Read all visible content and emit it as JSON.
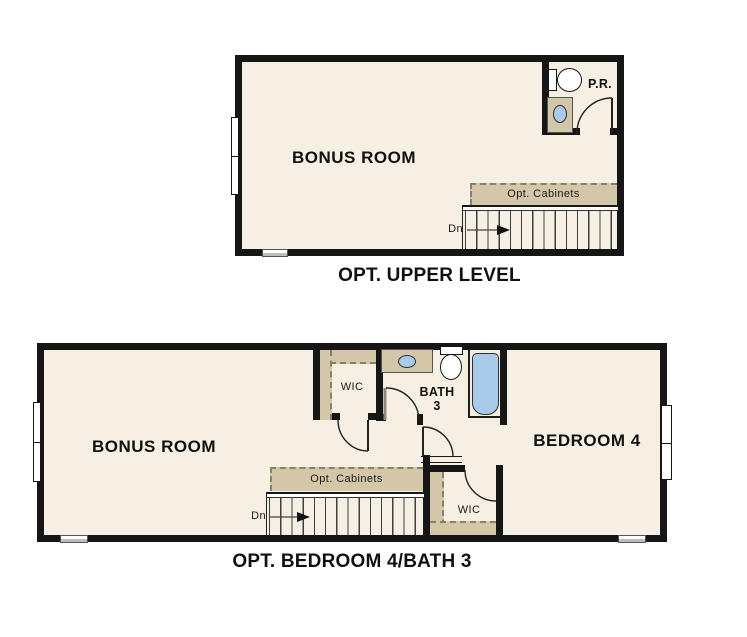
{
  "colors": {
    "floor": "#f5f0e3",
    "wall": "#161616",
    "cabinet_tan": "#d4c6a8",
    "fixture_blue": "#a9cae9",
    "window_gray": "#bdbdbd",
    "background": "#ffffff"
  },
  "plans": {
    "upper": {
      "caption": "OPT. UPPER LEVEL",
      "rooms": {
        "bonus_room": "BONUS ROOM",
        "powder_room": "P.R."
      },
      "stairs": {
        "direction_label": "Dn",
        "cabinets_label": "Opt. Cabinets"
      },
      "fixtures": [
        "toilet",
        "sink-vanity"
      ]
    },
    "bedroom_option": {
      "caption": "OPT. BEDROOM 4/BATH 3",
      "rooms": {
        "bonus_room": "BONUS ROOM",
        "bedroom": "BEDROOM 4",
        "bath_line1": "BATH",
        "bath_line2": "3",
        "wic_upper": "WIC",
        "wic_lower": "WIC"
      },
      "stairs": {
        "direction_label": "Dn",
        "cabinets_label": "Opt. Cabinets"
      },
      "fixtures": [
        "sink-vanity",
        "toilet",
        "bathtub"
      ]
    }
  }
}
